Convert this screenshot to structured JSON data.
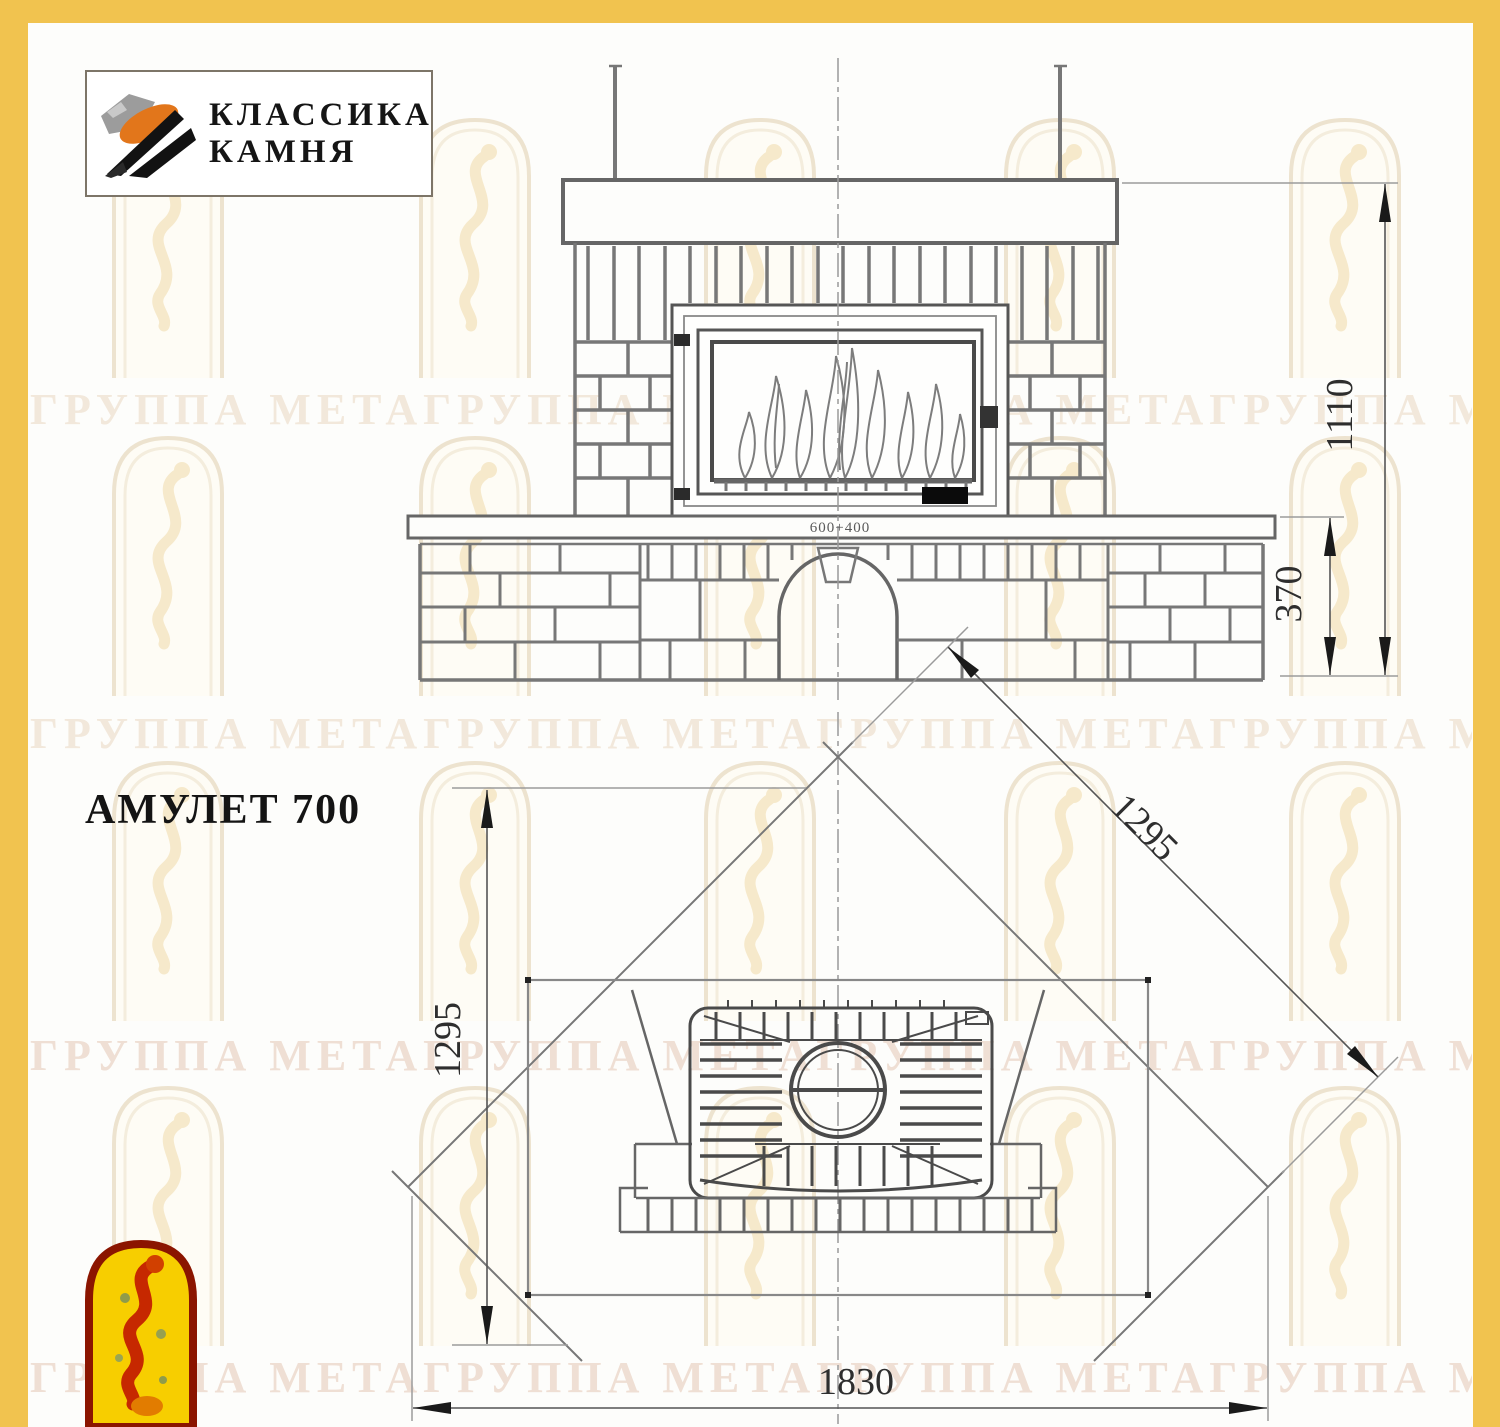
{
  "logo": {
    "line1": "КЛАССИКА",
    "line2": "КАМНЯ"
  },
  "title": "АМУЛЕТ 700",
  "watermark": {
    "text": "ГРУППА МЕТАГРУППА МЕТАГРУППА МЕТАГРУППА МЕТА"
  },
  "front_view": {
    "dim_total_height": "1110",
    "dim_bench_height": "370",
    "insert_label": "600+400"
  },
  "plan_view": {
    "dim_depth": "1295",
    "dim_diagonal": "1295",
    "dim_width": "1830"
  }
}
